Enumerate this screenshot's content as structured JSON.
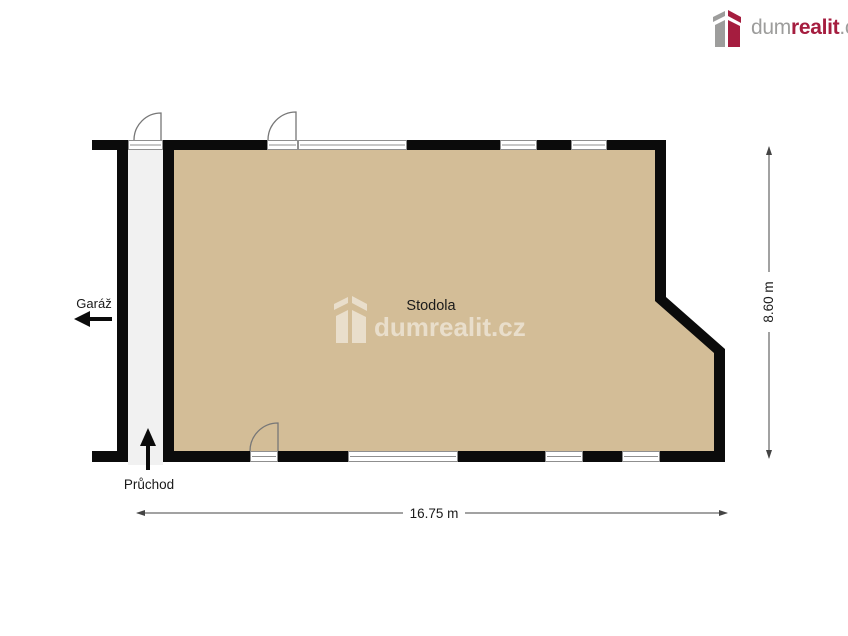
{
  "logo": {
    "prefix": "dum",
    "accent": "realit",
    "suffix": ".cz",
    "gray_color": "#9d9d9c",
    "red_color": "#a51d3f",
    "icon": "dumrealit-box-icon"
  },
  "watermark": {
    "text": "dumrealit.cz",
    "icon": "watermark-box-icon",
    "color": "rgba(255,255,255,0.5)"
  },
  "plan": {
    "room_label": "Stodola",
    "garage_label": "Garáž",
    "passage_label": "Průchod",
    "width_dimension": "16.75 m",
    "height_dimension": "8.60 m",
    "icons": {
      "garage_direction": "left-arrow-icon",
      "passage_direction": "up-arrow-icon"
    },
    "colors": {
      "floor": "#d3bd97",
      "wall": "#0b0b0b",
      "corridor": "#f1f1f1",
      "opening_line": "#8f8f8f",
      "door_arc": "#777777",
      "dimension_line": "#444444",
      "label_text": "#1a1a1a"
    }
  }
}
